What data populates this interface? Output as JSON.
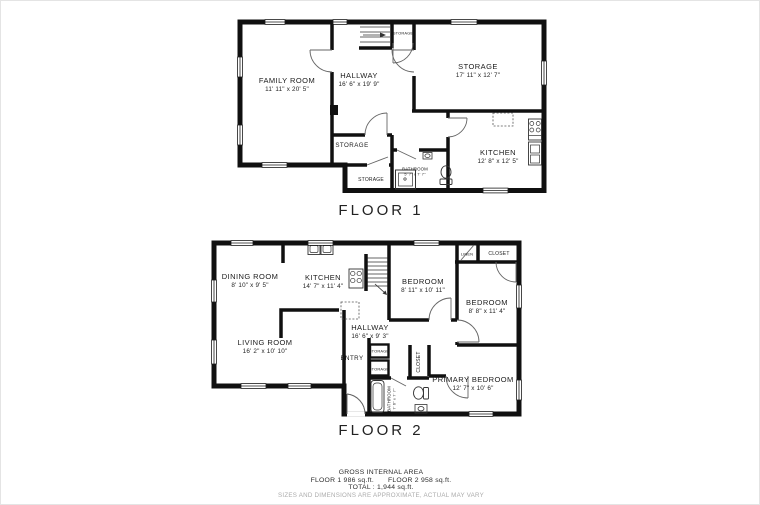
{
  "floor1": {
    "title": "FLOOR 1",
    "family_room": {
      "name": "FAMILY ROOM",
      "dims": "11' 11\" x 20' 5\""
    },
    "hallway": {
      "name": "HALLWAY",
      "dims": "16' 6\" x 19' 9\""
    },
    "storage_upper": {
      "name": "STORAGE",
      "dims": "17' 11\" x 12' 7\""
    },
    "kitchen": {
      "name": "KITCHEN",
      "dims": "12' 8\" x 12' 5\""
    },
    "storage_mid": {
      "name": "STORAGE"
    },
    "storage_lower": {
      "name": "STORAGE"
    },
    "stair_closet": {
      "name": "STORAGE"
    },
    "bathroom": {
      "name": "BATHROOM",
      "dims": "5' 7\" x 7' 7\""
    }
  },
  "floor2": {
    "title": "FLOOR 2",
    "dining_room": {
      "name": "DINING ROOM",
      "dims": "8' 10\" x 9' 5\""
    },
    "kitchen": {
      "name": "KITCHEN",
      "dims": "14' 7\" x 11' 4\""
    },
    "bedroom1": {
      "name": "BEDROOM",
      "dims": "8' 11\" x 10' 11\""
    },
    "bedroom2": {
      "name": "BEDROOM",
      "dims": "8' 8\" x 11' 4\""
    },
    "living_room": {
      "name": "LIVING ROOM",
      "dims": "16' 2\" x 10' 10\""
    },
    "hallway": {
      "name": "HALLWAY",
      "dims": "16' 6\" x 9' 3\""
    },
    "entry": {
      "name": "ENTRY"
    },
    "linen": {
      "name": "LINEN"
    },
    "closet_top": {
      "name": "CLOSET"
    },
    "closet_side": {
      "name": "CLOSET"
    },
    "storage_a": {
      "name": "STORAGE"
    },
    "storage_b": {
      "name": "STORAGE"
    },
    "primary_bedroom": {
      "name": "PRIMARY BEDROOM",
      "dims": "12' 7\" x 10' 6\""
    },
    "bathroom": {
      "name": "BATHROOM",
      "dims": "7' 6\" x 7' 7\""
    }
  },
  "footer": {
    "area_title": "GROSS INTERNAL AREA",
    "floor1_area": "FLOOR 1 986 sq.ft.",
    "floor2_area": "FLOOR 2 958 sq.ft.",
    "total": "TOTAL :   1,944 sq.ft.",
    "disclaimer": "SIZES AND DIMENSIONS ARE APPROXIMATE, ACTUAL MAY VARY"
  },
  "colors": {
    "wall": "#101010",
    "label_text": "#1b1b1b",
    "disclaimer_text": "#ababab"
  }
}
